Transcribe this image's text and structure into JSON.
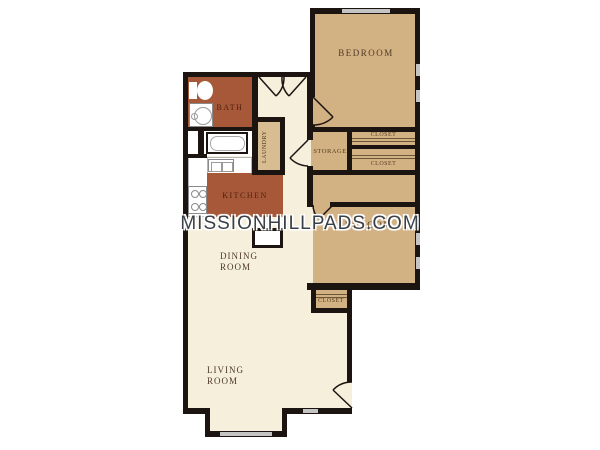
{
  "image": {
    "type": "apartment floor plan",
    "background": "#ffffff",
    "watermark": {
      "text": "MISSIONHILLPADS.COM",
      "color": "#3a4047"
    }
  },
  "palette": {
    "wall": "#1c1410",
    "floor_cream": "#f5efdc",
    "room_tan": "#d2b183",
    "room_red": "#a65838",
    "window_gray": "#c4c4c4",
    "label_brown": "#4e3a26"
  },
  "rooms": {
    "bedroom1": {
      "label": "BEDROOM"
    },
    "bedroom2": {
      "label": "BEDROOM"
    },
    "bath": {
      "label": "BATH"
    },
    "kitchen": {
      "label": "KITCHEN"
    },
    "laundry": {
      "label": "LAUNDRY"
    },
    "storage": {
      "label": "STORAGE"
    },
    "closet_upper": {
      "label": "CLOSET"
    },
    "closet_lower": {
      "label": "CLOSET"
    },
    "closet_bedroom2": {
      "label": "CLOSET"
    },
    "dining": {
      "line1": "DINING",
      "line2": "ROOM"
    },
    "living": {
      "line1": "LIVING",
      "line2": "ROOM"
    }
  }
}
